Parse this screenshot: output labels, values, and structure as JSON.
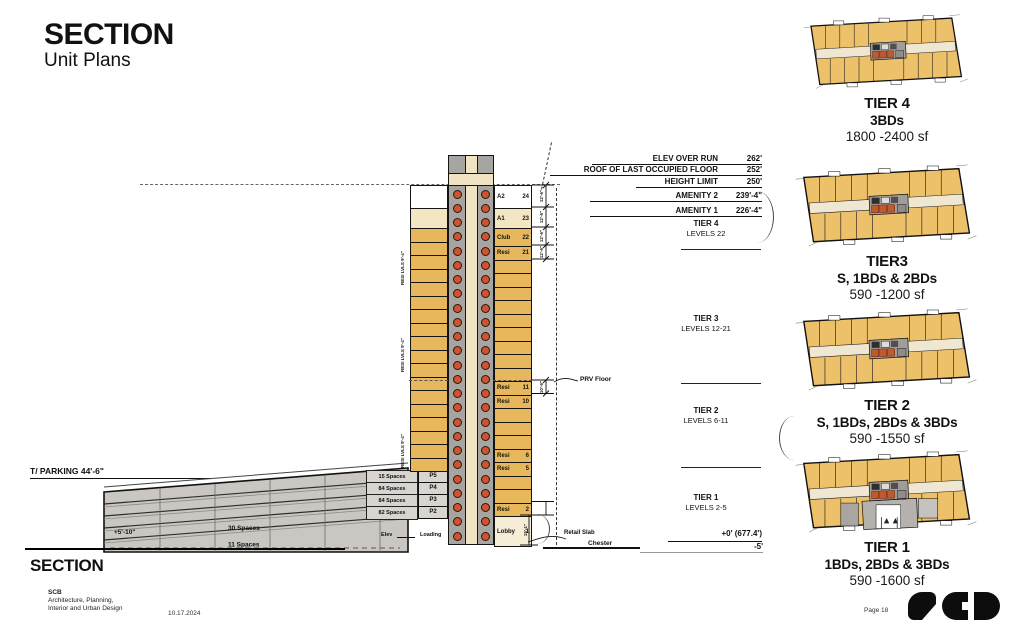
{
  "header": {
    "title": "SECTION",
    "subtitle": "Unit Plans"
  },
  "elevations": [
    {
      "label": "ELEV OVER RUN",
      "value": "262'"
    },
    {
      "label": "ROOF OF LAST OCCUPIED FLOOR",
      "value": "252'"
    },
    {
      "label": "HEIGHT LIMIT",
      "value": "250'"
    },
    {
      "label": "AMENITY 2",
      "value": "239'-4\""
    },
    {
      "label": "AMENITY 1",
      "value": "226'-4\""
    }
  ],
  "tiers": [
    {
      "name": "TIER 4",
      "levels": "LEVELS 22"
    },
    {
      "name": "TIER 3",
      "levels": "LEVELS 12-21"
    },
    {
      "name": "TIER 2",
      "levels": "LEVELS 6-11"
    },
    {
      "name": "TIER 1",
      "levels": "LEVELS 2-5"
    }
  ],
  "datum": {
    "zero": "+0' (677.4')",
    "minus5": "-5'"
  },
  "labels": {
    "prv": "PRV Floor",
    "retail_slab": "Retail Slab",
    "street": "Chester",
    "t_parking": "T/ PARKING  44'-6\""
  },
  "parking": {
    "space_rows": [
      "15 Spaces",
      "84 Spaces",
      "84 Spaces",
      "82 Spaces"
    ],
    "p_levels": [
      "P5",
      "P4",
      "P3",
      "P2"
    ],
    "row30": "30 Spaces",
    "row11": "11 Spaces",
    "clearance": "+5'-10\"",
    "elev": "Elev",
    "loading": "Loading"
  },
  "tower": {
    "dim_typ": "12'-6\"",
    "dim_prv": "10'-6\"",
    "dim_lobby": "15'-1\"",
    "side_dim": "RESI LVLS 9'-4\"",
    "floors": [
      {
        "label": "A2",
        "num": "24",
        "kind": "amenity-top"
      },
      {
        "label": "A1",
        "num": "23",
        "kind": "amenity"
      },
      {
        "label": "Club",
        "num": "22",
        "kind": "club"
      },
      {
        "label": "Resi",
        "num": "21",
        "kind": "resi"
      },
      {
        "label": "",
        "num": "",
        "kind": "plain"
      },
      {
        "label": "",
        "num": "",
        "kind": "plain"
      },
      {
        "label": "",
        "num": "",
        "kind": "plain"
      },
      {
        "label": "",
        "num": "",
        "kind": "plain"
      },
      {
        "label": "",
        "num": "",
        "kind": "plain"
      },
      {
        "label": "",
        "num": "",
        "kind": "plain"
      },
      {
        "label": "",
        "num": "",
        "kind": "plain"
      },
      {
        "label": "",
        "num": "",
        "kind": "plain"
      },
      {
        "label": "",
        "num": "",
        "kind": "plain"
      },
      {
        "label": "Resi",
        "num": "11",
        "kind": "resi"
      },
      {
        "label": "Resi",
        "num": "10",
        "kind": "resi"
      },
      {
        "label": "",
        "num": "",
        "kind": "plain"
      },
      {
        "label": "",
        "num": "",
        "kind": "plain"
      },
      {
        "label": "",
        "num": "",
        "kind": "plain"
      },
      {
        "label": "Resi",
        "num": "6",
        "kind": "resi"
      },
      {
        "label": "Resi",
        "num": "5",
        "kind": "resi"
      },
      {
        "label": "",
        "num": "",
        "kind": "plain"
      },
      {
        "label": "",
        "num": "",
        "kind": "plain"
      },
      {
        "label": "Resi",
        "num": "2",
        "kind": "resi"
      },
      {
        "label": "Lobby",
        "num": "1",
        "kind": "lobby"
      }
    ]
  },
  "plans": [
    {
      "name": "TIER 4",
      "types": "3BDs",
      "sf": "1800 -2400 sf"
    },
    {
      "name": "TIER3",
      "types": "S, 1BDs & 2BDs",
      "sf": "590 -1200 sf"
    },
    {
      "name": "TIER 2",
      "types": "S, 1BDs, 2BDs & 3BDs",
      "sf": "590 -1550 sf"
    },
    {
      "name": "TIER 1",
      "types": "1BDs, 2BDs & 3BDs",
      "sf": "590 -1600 sf"
    }
  ],
  "footer": {
    "section": "SECTION",
    "firm": "SCB",
    "firm_line1": "Architecture, Planning,",
    "firm_line2": "Interior and Urban Design",
    "date": "10.17.2024",
    "page": "Page 18"
  }
}
